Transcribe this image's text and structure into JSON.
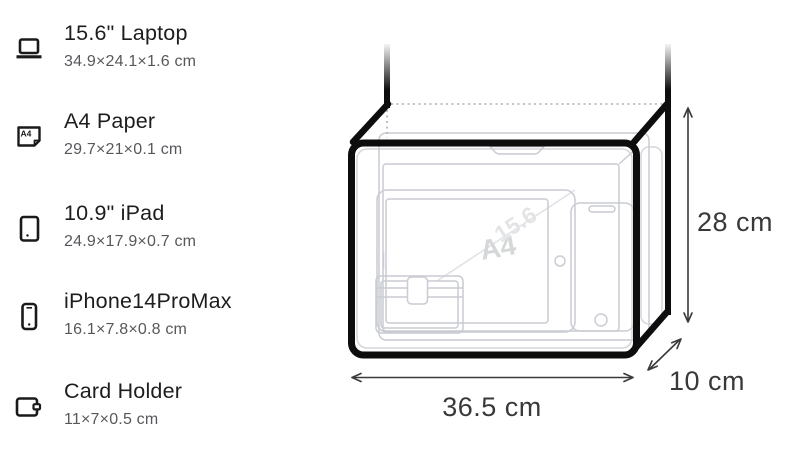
{
  "items": [
    {
      "name": "15.6\" Laptop",
      "size": "34.9×24.1×1.6 cm",
      "icon": "laptop-icon"
    },
    {
      "name": "A4 Paper",
      "size": "29.7×21×0.1 cm",
      "icon": "a4-paper-icon",
      "icon_label": "A4"
    },
    {
      "name": "10.9\" iPad",
      "size": "24.9×17.9×0.7 cm",
      "icon": "tablet-icon"
    },
    {
      "name": "iPhone14ProMax",
      "size": "16.1×7.8×0.8 cm",
      "icon": "phone-icon"
    },
    {
      "name": "Card Holder",
      "size": "11×7×0.5 cm",
      "icon": "wallet-icon"
    }
  ],
  "diagram": {
    "height_label": "28 cm",
    "width_label": "36.5 cm",
    "depth_label": "10 cm",
    "watermarks": {
      "a4": "A4",
      "laptop": "15.6"
    },
    "colors": {
      "bag_outline": "#0d0d0d",
      "item_outline": "#c9ccd2",
      "dimension_text": "#39393b"
    }
  }
}
